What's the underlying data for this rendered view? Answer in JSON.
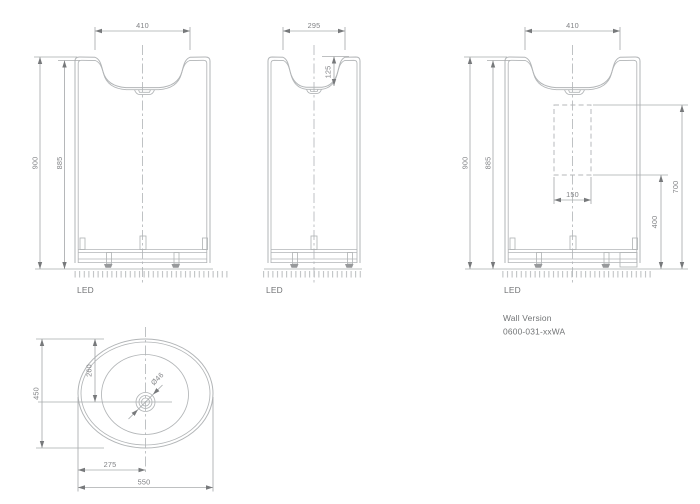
{
  "drawing_type": "washbasin technical dimension drawing",
  "colors": {
    "background": "#ffffff",
    "outline_gray": "#b2b5b7",
    "dimension_gray": "#a8abad",
    "dim_text_gray": "#808285",
    "label_text_gray": "#717375"
  },
  "views": {
    "front": {
      "dim_top_width": "410",
      "dim_height": "900",
      "dim_height_inner": "885",
      "floor_label": "LED"
    },
    "side": {
      "dim_top_width": "295",
      "dim_basin_depth": "125",
      "floor_label": "LED"
    },
    "wall": {
      "dim_top_width": "410",
      "dim_height": "900",
      "dim_height_inner": "885",
      "dim_bracket_width": "150",
      "dim_bracket_bottom": "400",
      "dim_bracket_top": "700",
      "floor_label": "LED",
      "caption_line1": "Wall Version",
      "caption_line2": "0600-031-xxWA"
    },
    "plan": {
      "dim_depth": "450",
      "dim_drain_from_back": "260",
      "dim_drain_from_left": "275",
      "dim_width": "550",
      "dim_drain_diameter": "Ø46"
    }
  }
}
